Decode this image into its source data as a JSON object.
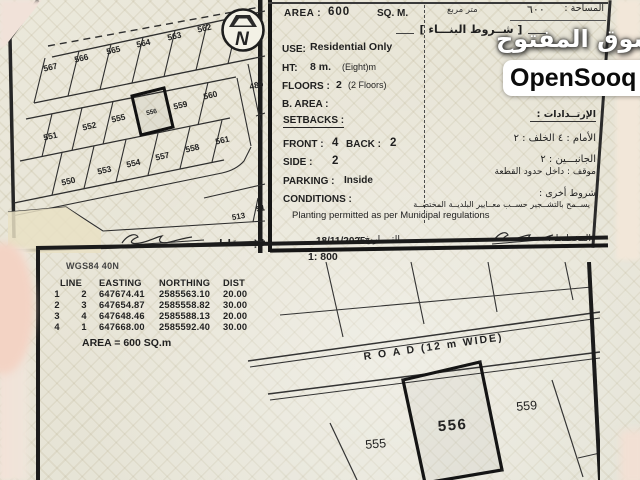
{
  "watermark": {
    "brand_ar": "السوق المفتوح",
    "brand_en": "OpenSooq"
  },
  "map_panel": {
    "plots": [
      "567",
      "566",
      "565",
      "564",
      "563",
      "562",
      "551",
      "552",
      "555",
      "556",
      "559",
      "560",
      "550",
      "553",
      "554",
      "557",
      "558",
      "561",
      "489",
      "513",
      "51"
    ],
    "highlighted_plot": "556",
    "projection_label_ar": "الإســقاط",
    "north_letter": "N"
  },
  "details_panel": {
    "area_label": "AREA :",
    "area_value": "600",
    "area_unit": "SQ. M.",
    "area_unit_ar": "متر مربع",
    "area_value_ar": "٦٠٠",
    "area_label_ar": "المساحة :",
    "building_terms_ar": "[ شــروط البنـــاء ]",
    "use_label": "USE:",
    "use_value": "Residential Only",
    "height_label": "HT:",
    "height_value": "8 m.",
    "height_note": "(Eight)m",
    "floors_label": "FLOORS :",
    "floors_value": "2",
    "floors_note": "(2 Floors)",
    "built_area_label": "B. AREA :",
    "setbacks_label": "SETBACKS :",
    "front_label": "FRONT :",
    "front_value": "4",
    "back_label": "BACK :",
    "back_value": "2",
    "side_label": "SIDE :",
    "side_value": "2",
    "parking_label": "PARKING :",
    "parking_value": "Inside",
    "conditions_label": "CONDITIONS :",
    "conditions_text": "Planting permitted as per Municipal regulations",
    "date_value": "18/11/2025",
    "date_label_ar": "التــــاريخ :",
    "setbacks_ar": "الإرتــدادات :",
    "front_back_ar": "الأمام : ٤      الخلف : ٢",
    "sides_ar": "الجانبـــين : ٢",
    "parking_ar": "موقف :  داخل حدود القطعة",
    "other_terms_ar": "شروط أخرى :",
    "planting_ar": "يســمح بالتشــجير حســب معــايير البلديــة المختصــة",
    "plan_label_ar": "المخطـط :"
  },
  "survey_panel": {
    "scale": "1: 800",
    "datum": "WGS84 40N",
    "table": {
      "col_line": "LINE",
      "col_easting": "EASTING",
      "col_northing": "NORTHING",
      "col_dist": "DIST",
      "rows": [
        [
          "1",
          "2",
          "647674.41",
          "2585563.10",
          "20.00"
        ],
        [
          "2",
          "3",
          "647654.87",
          "2585558.82",
          "30.00"
        ],
        [
          "3",
          "4",
          "647648.46",
          "2585588.13",
          "20.00"
        ],
        [
          "4",
          "1",
          "647668.00",
          "2585592.40",
          "30.00"
        ]
      ]
    },
    "area_text": "AREA = 600  SQ.m",
    "diagram": {
      "road_label": "R O A D (12 m WIDE)",
      "plot_main": "556",
      "plot_left": "555",
      "plot_right": "559"
    }
  }
}
